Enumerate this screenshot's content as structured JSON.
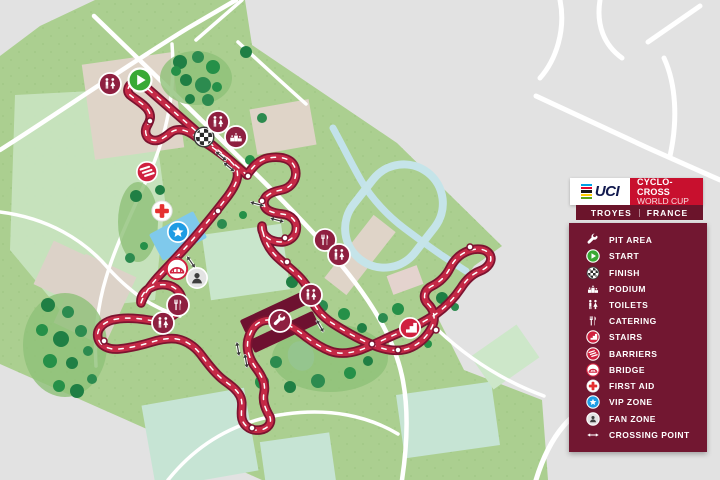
{
  "header": {
    "uci": "UCI",
    "series_line1": "CYCLO-CROSS",
    "series_line2": "WORLD CUP",
    "event_city": "TROYES",
    "event_country": "FRANCE"
  },
  "colors": {
    "panel_maroon": "#721731",
    "bar_maroon": "#6B142B",
    "series_red": "#C8102E",
    "course_edge": "#7C1330",
    "course_fill": "#C42946",
    "badge_maroon": "#8E2040",
    "badge_red": "#D0213F",
    "start_green": "#39A935",
    "vip_blue": "#1F9CE4",
    "firstaid_red": "#E53030",
    "park_green": "#ABCF90",
    "map_grey": "#E2E2E2",
    "water_blue": "#BFE0EA"
  },
  "legend": {
    "items": [
      {
        "id": "pit-area",
        "label": "PIT AREA",
        "icon": "pit"
      },
      {
        "id": "start",
        "label": "START",
        "icon": "start"
      },
      {
        "id": "finish",
        "label": "FINISH",
        "icon": "finish"
      },
      {
        "id": "podium",
        "label": "PODIUM",
        "icon": "podium"
      },
      {
        "id": "toilets",
        "label": "TOILETS",
        "icon": "toilets"
      },
      {
        "id": "catering",
        "label": "CATERING",
        "icon": "catering"
      },
      {
        "id": "stairs",
        "label": "STAIRS",
        "icon": "stairs"
      },
      {
        "id": "barriers",
        "label": "BARRIERS",
        "icon": "barriers"
      },
      {
        "id": "bridge",
        "label": "BRIDGE",
        "icon": "bridge"
      },
      {
        "id": "first-aid",
        "label": "FIRST AID",
        "icon": "firstaid"
      },
      {
        "id": "vip-zone",
        "label": "VIP ZONE",
        "icon": "vip"
      },
      {
        "id": "fan-zone",
        "label": "FAN ZONE",
        "icon": "fanzone"
      },
      {
        "id": "crossing-point",
        "label": "CROSSING POINT",
        "icon": "crossing"
      }
    ]
  },
  "map": {
    "markers": [
      {
        "icon": "toilets",
        "x": 110,
        "y": 84
      },
      {
        "icon": "start",
        "x": 140,
        "y": 80
      },
      {
        "icon": "finish",
        "x": 204,
        "y": 137
      },
      {
        "icon": "toilets",
        "x": 218,
        "y": 122
      },
      {
        "icon": "podium",
        "x": 236,
        "y": 137
      },
      {
        "icon": "barriers",
        "x": 147,
        "y": 172
      },
      {
        "icon": "firstaid",
        "x": 162,
        "y": 211
      },
      {
        "icon": "vip",
        "x": 178,
        "y": 232
      },
      {
        "icon": "bridge",
        "x": 177,
        "y": 269
      },
      {
        "icon": "fanzone",
        "x": 197,
        "y": 278
      },
      {
        "icon": "catering",
        "x": 178,
        "y": 305
      },
      {
        "icon": "toilets",
        "x": 163,
        "y": 323
      },
      {
        "icon": "catering",
        "x": 325,
        "y": 240
      },
      {
        "icon": "toilets",
        "x": 339,
        "y": 255
      },
      {
        "icon": "toilets",
        "x": 311,
        "y": 295
      },
      {
        "icon": "pit",
        "x": 280,
        "y": 321
      },
      {
        "icon": "stairs",
        "x": 410,
        "y": 328
      }
    ],
    "crossings": [
      {
        "x": 221,
        "y": 156,
        "a": 40
      },
      {
        "x": 229,
        "y": 167,
        "a": 40
      },
      {
        "x": 257,
        "y": 204,
        "a": 15
      },
      {
        "x": 277,
        "y": 220,
        "a": 15
      },
      {
        "x": 191,
        "y": 262,
        "a": 55
      },
      {
        "x": 238,
        "y": 349,
        "a": 80
      },
      {
        "x": 246,
        "y": 361,
        "a": 80
      },
      {
        "x": 320,
        "y": 326,
        "a": 60
      }
    ],
    "course_dots": [
      {
        "x": 150,
        "y": 121
      },
      {
        "x": 248,
        "y": 176
      },
      {
        "x": 262,
        "y": 201
      },
      {
        "x": 287,
        "y": 262
      },
      {
        "x": 372,
        "y": 344
      },
      {
        "x": 436,
        "y": 330
      },
      {
        "x": 470,
        "y": 247
      },
      {
        "x": 104,
        "y": 341
      },
      {
        "x": 252,
        "y": 428
      },
      {
        "x": 178,
        "y": 260
      },
      {
        "x": 218,
        "y": 211
      },
      {
        "x": 285,
        "y": 238
      },
      {
        "x": 308,
        "y": 292
      },
      {
        "x": 398,
        "y": 350
      }
    ],
    "tree_blobs": [
      {
        "x": 196,
        "y": 78,
        "rx": 36,
        "ry": 27
      },
      {
        "x": 65,
        "y": 345,
        "rx": 42,
        "ry": 52
      },
      {
        "x": 330,
        "y": 358,
        "rx": 58,
        "ry": 34
      },
      {
        "x": 138,
        "y": 222,
        "rx": 20,
        "ry": 40
      }
    ],
    "trees": [
      {
        "x": 180,
        "y": 62,
        "r": 7
      },
      {
        "x": 198,
        "y": 57,
        "r": 6
      },
      {
        "x": 213,
        "y": 67,
        "r": 7
      },
      {
        "x": 186,
        "y": 80,
        "r": 6
      },
      {
        "x": 203,
        "y": 85,
        "r": 8
      },
      {
        "x": 217,
        "y": 87,
        "r": 5
      },
      {
        "x": 190,
        "y": 99,
        "r": 5
      },
      {
        "x": 208,
        "y": 100,
        "r": 6
      },
      {
        "x": 176,
        "y": 71,
        "r": 5
      },
      {
        "x": 246,
        "y": 52,
        "r": 6
      },
      {
        "x": 262,
        "y": 118,
        "r": 5
      },
      {
        "x": 250,
        "y": 160,
        "r": 5
      },
      {
        "x": 136,
        "y": 196,
        "r": 6
      },
      {
        "x": 130,
        "y": 258,
        "r": 5
      },
      {
        "x": 144,
        "y": 246,
        "r": 4
      },
      {
        "x": 160,
        "y": 190,
        "r": 5
      },
      {
        "x": 222,
        "y": 224,
        "r": 5
      },
      {
        "x": 243,
        "y": 215,
        "r": 4
      },
      {
        "x": 292,
        "y": 282,
        "r": 6
      },
      {
        "x": 322,
        "y": 306,
        "r": 6
      },
      {
        "x": 344,
        "y": 314,
        "r": 6
      },
      {
        "x": 362,
        "y": 328,
        "r": 5
      },
      {
        "x": 276,
        "y": 362,
        "r": 6
      },
      {
        "x": 262,
        "y": 382,
        "r": 7
      },
      {
        "x": 290,
        "y": 387,
        "r": 6
      },
      {
        "x": 318,
        "y": 381,
        "r": 7
      },
      {
        "x": 350,
        "y": 373,
        "r": 6
      },
      {
        "x": 368,
        "y": 361,
        "r": 5
      },
      {
        "x": 383,
        "y": 318,
        "r": 5
      },
      {
        "x": 398,
        "y": 309,
        "r": 6
      },
      {
        "x": 442,
        "y": 298,
        "r": 6
      },
      {
        "x": 455,
        "y": 307,
        "r": 4
      },
      {
        "x": 428,
        "y": 344,
        "r": 4
      },
      {
        "x": 48,
        "y": 305,
        "r": 7
      },
      {
        "x": 68,
        "y": 312,
        "r": 6
      },
      {
        "x": 42,
        "y": 330,
        "r": 6
      },
      {
        "x": 61,
        "y": 339,
        "r": 8
      },
      {
        "x": 81,
        "y": 331,
        "r": 6
      },
      {
        "x": 50,
        "y": 361,
        "r": 7
      },
      {
        "x": 72,
        "y": 363,
        "r": 6
      },
      {
        "x": 88,
        "y": 351,
        "r": 5
      },
      {
        "x": 59,
        "y": 386,
        "r": 6
      },
      {
        "x": 77,
        "y": 391,
        "r": 7
      },
      {
        "x": 92,
        "y": 379,
        "r": 5
      }
    ]
  }
}
